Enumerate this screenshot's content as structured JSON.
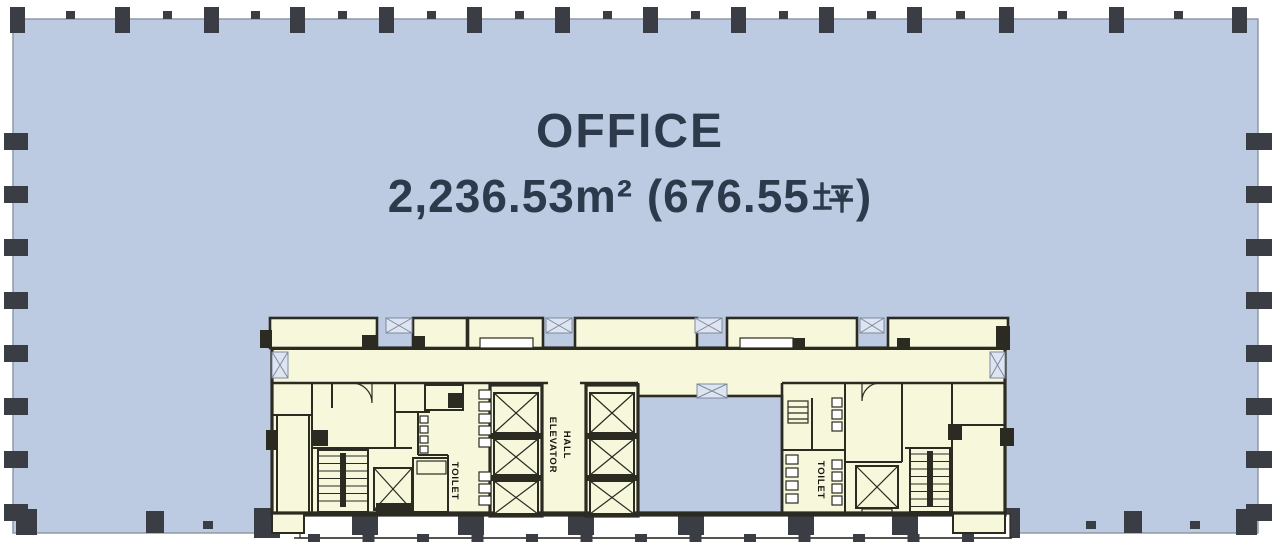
{
  "floor_plan": {
    "office_label": "OFFICE",
    "area_label_full": "2,236.53m² (676.55 坪)",
    "area_prefix": "2,236.53m² (676.55",
    "area_tsubo_char": "坪",
    "area_suffix": ")",
    "core": {
      "elevator_hall_line1": "ELEVATOR",
      "elevator_hall_line2": "HALL",
      "toilet_left_label": "TOILET",
      "toilet_right_label": "TOILET"
    }
  },
  "colors": {
    "office_floor_blue": "#bccbe2",
    "core_cream": "#f7f7dc",
    "wall_dark": "#2b2b22",
    "column_dark": "#3a3e44",
    "title_text_navy": "#2c3a4c",
    "door_symbol_fill": "#dfe5f0",
    "door_symbol_stroke": "#7c8aa0",
    "floor_border_gray": "#8a93a2"
  }
}
